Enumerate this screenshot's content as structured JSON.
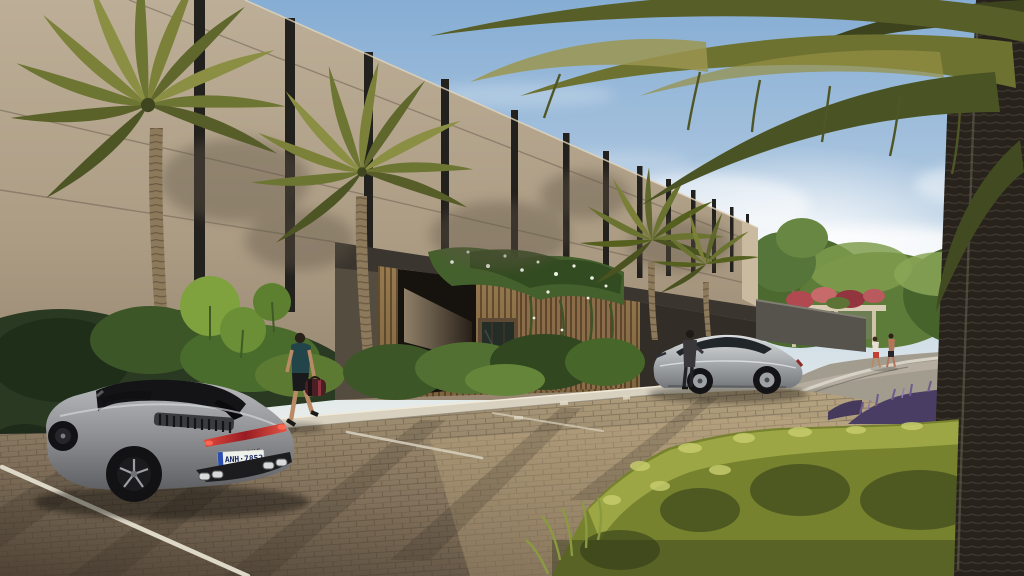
{
  "sports_car": {
    "license_plate": "ANH·7852",
    "brand_lettering": "PORSCHE"
  },
  "palette": {
    "sky": "#8fb3d6",
    "cloud_glare": "#ffffff",
    "facade": "#b3a48c",
    "facade_dark_band": "#3a352e",
    "entrance_wood": "#9c7f5c",
    "foliage_dark": "#2c421f",
    "foliage_bright": "#9aa646",
    "paver_sun": "#c2ad89",
    "paver_shade": "#5e5142",
    "taillight_red": "#c12f33",
    "plate_blue": "#2a4db0",
    "purple_flowers": "#5c4a78",
    "car_silver": "#9a9b9e"
  }
}
